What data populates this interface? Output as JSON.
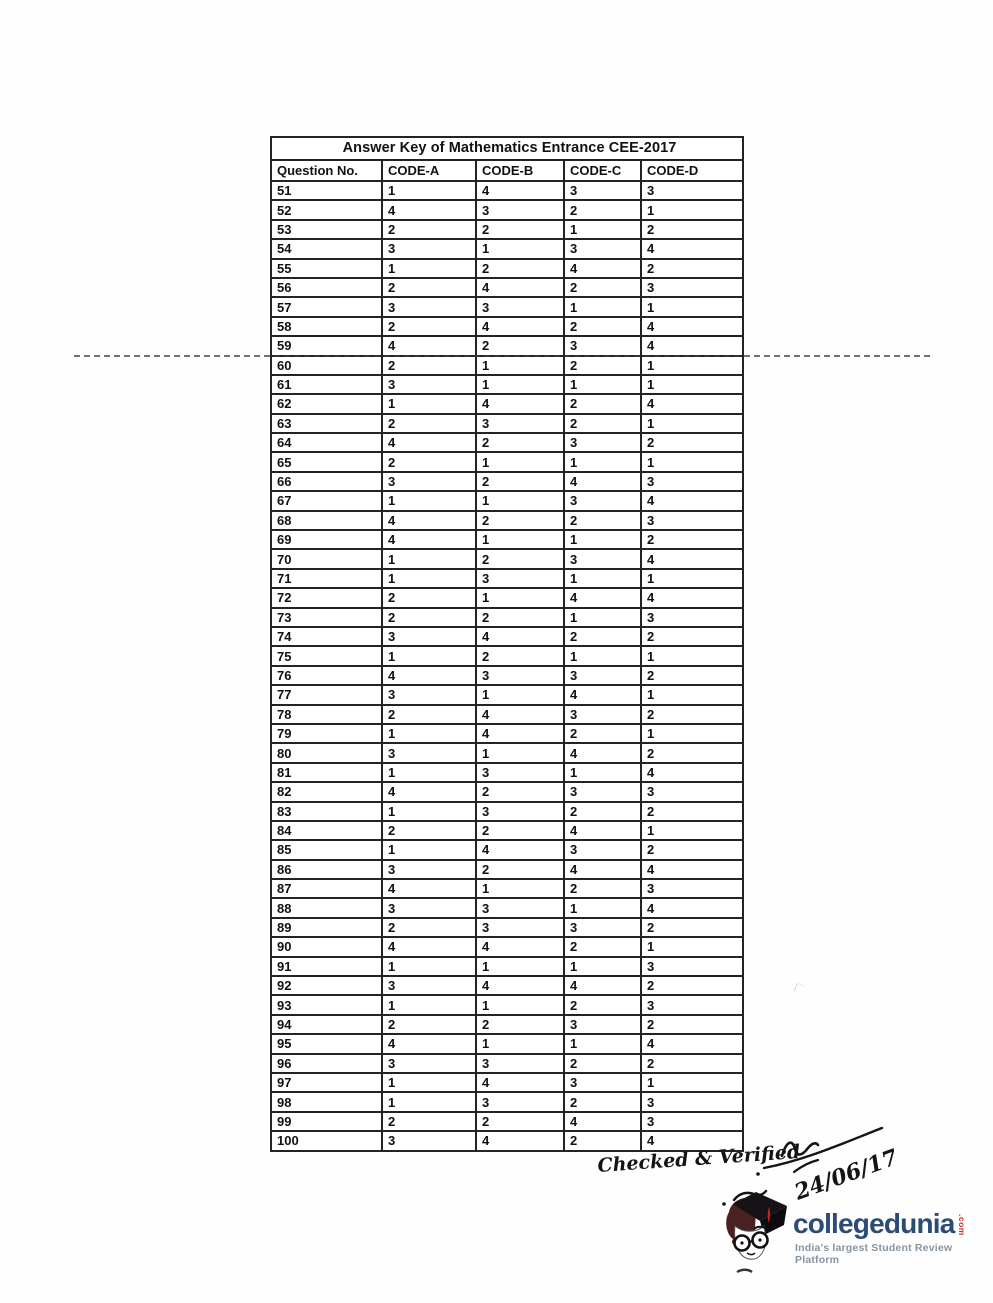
{
  "table": {
    "title": "Answer Key of Mathematics Entrance CEE-2017",
    "headers": [
      "Question No.",
      "CODE-A",
      "CODE-B",
      "CODE-C",
      "CODE-D"
    ],
    "rows": [
      {
        "q": "51",
        "a": "1",
        "b": "4",
        "c": "3",
        "d": "3"
      },
      {
        "q": "52",
        "a": "4",
        "b": "3",
        "c": "2",
        "d": "1"
      },
      {
        "q": "53",
        "a": "2",
        "b": "2",
        "c": "1",
        "d": "2"
      },
      {
        "q": "54",
        "a": "3",
        "b": "1",
        "c": "3",
        "d": "4"
      },
      {
        "q": "55",
        "a": "1",
        "b": "2",
        "c": "4",
        "d": "2"
      },
      {
        "q": "56",
        "a": "2",
        "b": "4",
        "c": "2",
        "d": "3"
      },
      {
        "q": "57",
        "a": "3",
        "b": "3",
        "c": "1",
        "d": "1"
      },
      {
        "q": "58",
        "a": "2",
        "b": "4",
        "c": "2",
        "d": "4"
      },
      {
        "q": "59",
        "a": "4",
        "b": "2",
        "c": "3",
        "d": "4"
      },
      {
        "q": "60",
        "a": "2",
        "b": "1",
        "c": "2",
        "d": "1"
      },
      {
        "q": "61",
        "a": "3",
        "b": "1",
        "c": "1",
        "d": "1"
      },
      {
        "q": "62",
        "a": "1",
        "b": "4",
        "c": "2",
        "d": "4"
      },
      {
        "q": "63",
        "a": "2",
        "b": "3",
        "c": "2",
        "d": "1"
      },
      {
        "q": "64",
        "a": "4",
        "b": "2",
        "c": "3",
        "d": "2"
      },
      {
        "q": "65",
        "a": "2",
        "b": "1",
        "c": "1",
        "d": "1"
      },
      {
        "q": "66",
        "a": "3",
        "b": "2",
        "c": "4",
        "d": "3"
      },
      {
        "q": "67",
        "a": "1",
        "b": "1",
        "c": "3",
        "d": "4"
      },
      {
        "q": "68",
        "a": "4",
        "b": "2",
        "c": "2",
        "d": "3"
      },
      {
        "q": "69",
        "a": "4",
        "b": "1",
        "c": "1",
        "d": "2"
      },
      {
        "q": "70",
        "a": "1",
        "b": "2",
        "c": "3",
        "d": "4"
      },
      {
        "q": "71",
        "a": "1",
        "b": "3",
        "c": "1",
        "d": "1"
      },
      {
        "q": "72",
        "a": "2",
        "b": "1",
        "c": "4",
        "d": "4"
      },
      {
        "q": "73",
        "a": "2",
        "b": "2",
        "c": "1",
        "d": "3"
      },
      {
        "q": "74",
        "a": "3",
        "b": "4",
        "c": "2",
        "d": "2"
      },
      {
        "q": "75",
        "a": "1",
        "b": "2",
        "c": "1",
        "d": "1"
      },
      {
        "q": "76",
        "a": "4",
        "b": "3",
        "c": "3",
        "d": "2"
      },
      {
        "q": "77",
        "a": "3",
        "b": "1",
        "c": "4",
        "d": "1"
      },
      {
        "q": "78",
        "a": "2",
        "b": "4",
        "c": "3",
        "d": "2"
      },
      {
        "q": "79",
        "a": "1",
        "b": "4",
        "c": "2",
        "d": "1"
      },
      {
        "q": "80",
        "a": "3",
        "b": "1",
        "c": "4",
        "d": "2"
      },
      {
        "q": "81",
        "a": "1",
        "b": "3",
        "c": "1",
        "d": "4"
      },
      {
        "q": "82",
        "a": "4",
        "b": "2",
        "c": "3",
        "d": "3"
      },
      {
        "q": "83",
        "a": "1",
        "b": "3",
        "c": "2",
        "d": "2"
      },
      {
        "q": "84",
        "a": "2",
        "b": "2",
        "c": "4",
        "d": "1"
      },
      {
        "q": "85",
        "a": "1",
        "b": "4",
        "c": "3",
        "d": "2"
      },
      {
        "q": "86",
        "a": "3",
        "b": "2",
        "c": "4",
        "d": "4"
      },
      {
        "q": "87",
        "a": "4",
        "b": "1",
        "c": "2",
        "d": "3"
      },
      {
        "q": "88",
        "a": "3",
        "b": "3",
        "c": "1",
        "d": "4"
      },
      {
        "q": "89",
        "a": "2",
        "b": "3",
        "c": "3",
        "d": "2"
      },
      {
        "q": "90",
        "a": "4",
        "b": "4",
        "c": "2",
        "d": "1"
      },
      {
        "q": "91",
        "a": "1",
        "b": "1",
        "c": "1",
        "d": "3"
      },
      {
        "q": "92",
        "a": "3",
        "b": "4",
        "c": "4",
        "d": "2"
      },
      {
        "q": "93",
        "a": "1",
        "b": "1",
        "c": "2",
        "d": "3"
      },
      {
        "q": "94",
        "a": "2",
        "b": "2",
        "c": "3",
        "d": "2"
      },
      {
        "q": "95",
        "a": "4",
        "b": "1",
        "c": "1",
        "d": "4"
      },
      {
        "q": "96",
        "a": "3",
        "b": "3",
        "c": "2",
        "d": "2"
      },
      {
        "q": "97",
        "a": "1",
        "b": "4",
        "c": "3",
        "d": "1"
      },
      {
        "q": "98",
        "a": "1",
        "b": "3",
        "c": "2",
        "d": "3"
      },
      {
        "q": "99",
        "a": "2",
        "b": "2",
        "c": "4",
        "d": "3"
      },
      {
        "q": "100",
        "a": "3",
        "b": "4",
        "c": "2",
        "d": "4"
      }
    ]
  },
  "annotation": {
    "checked_text": "Checked & Verified",
    "date": "24/06/17"
  },
  "logo": {
    "name": "collegedunia",
    "tld": ".com",
    "tagline": "India's largest Student Review Platform",
    "brand_color": "#2d4b77",
    "accent_color": "#cc2a29",
    "tagline_color": "#8694a2"
  }
}
